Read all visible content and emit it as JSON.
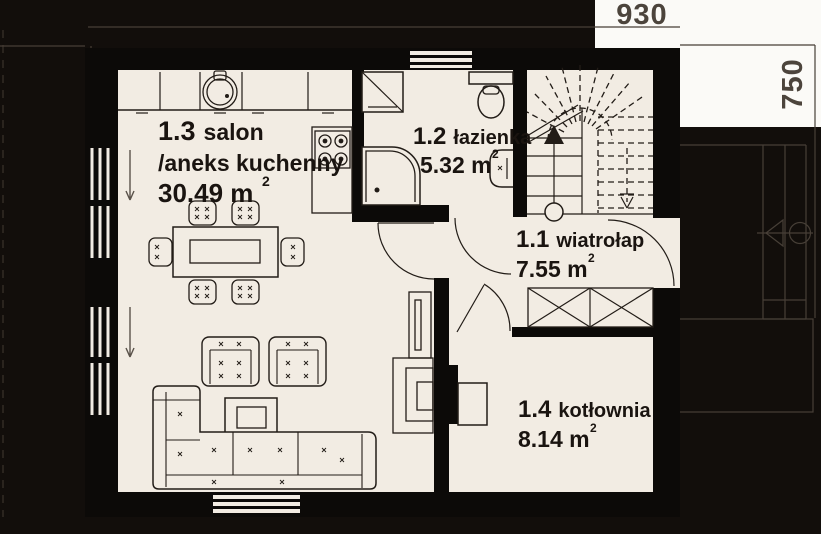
{
  "dimensions": {
    "width_label": "930",
    "height_label": "750"
  },
  "rooms": {
    "salon": {
      "number": "1.3",
      "name": "salon",
      "name_line2": "/aneks kuchenny",
      "area": "30.49 m",
      "area_exponent": "2"
    },
    "lazienka": {
      "number": "1.2",
      "name": "łazienka",
      "area": "5.32 m",
      "area_exponent": "2"
    },
    "wiatrolap": {
      "number": "1.1",
      "name": "wiatrołap",
      "area": "7.55 m",
      "area_exponent": "2"
    },
    "kotlownia": {
      "number": "1.4",
      "name": "kotłownia",
      "area": "8.14 m",
      "area_exponent": "2"
    }
  },
  "colors": {
    "background": "#120e0b",
    "walls": "#0c0a08",
    "floor": "#f2ece3",
    "label_panel": "#fbfaf7",
    "annotation": "#473f37",
    "ink": "#221c17",
    "dimension_text": "#4c443c"
  }
}
